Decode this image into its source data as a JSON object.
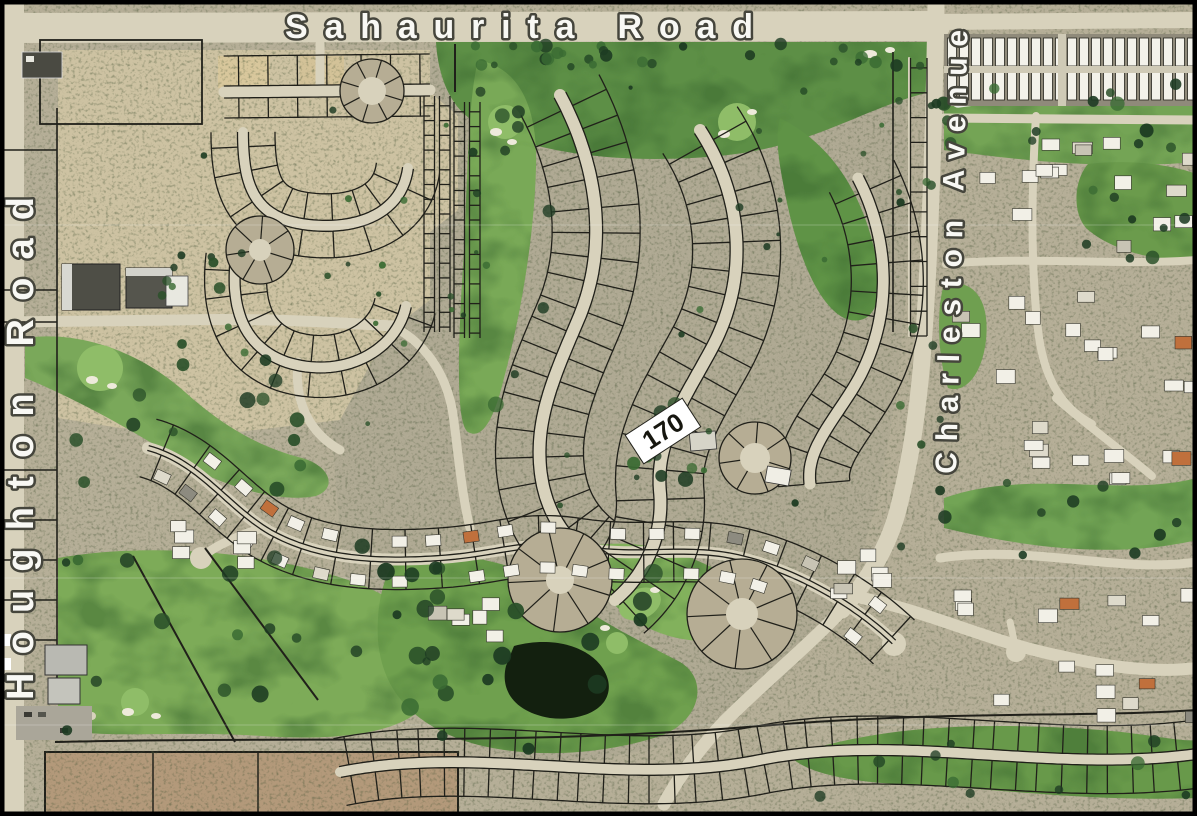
{
  "map": {
    "road_labels": {
      "top": {
        "text": "Sahaurita Road"
      },
      "left": {
        "text": "Houghton Road"
      },
      "right": {
        "text": "Charleston Avenue"
      }
    },
    "parcel_label": {
      "text": "170"
    },
    "colors": {
      "desert_base": "#b5ae97",
      "scrub_tint": "#aaa690",
      "graded_lot": "#cdc2a2",
      "dirt_block": "#b3997a",
      "golf_green": "#72a150",
      "golf_dark": "#39662f",
      "road_light": "#d8d2bc",
      "parcel_line": "#20201a",
      "pond": "#13200f",
      "house_roof": "#f2f0e7",
      "label_fill": "#f8f8f4",
      "label_outline": "#45453c",
      "border": "#000000"
    }
  }
}
